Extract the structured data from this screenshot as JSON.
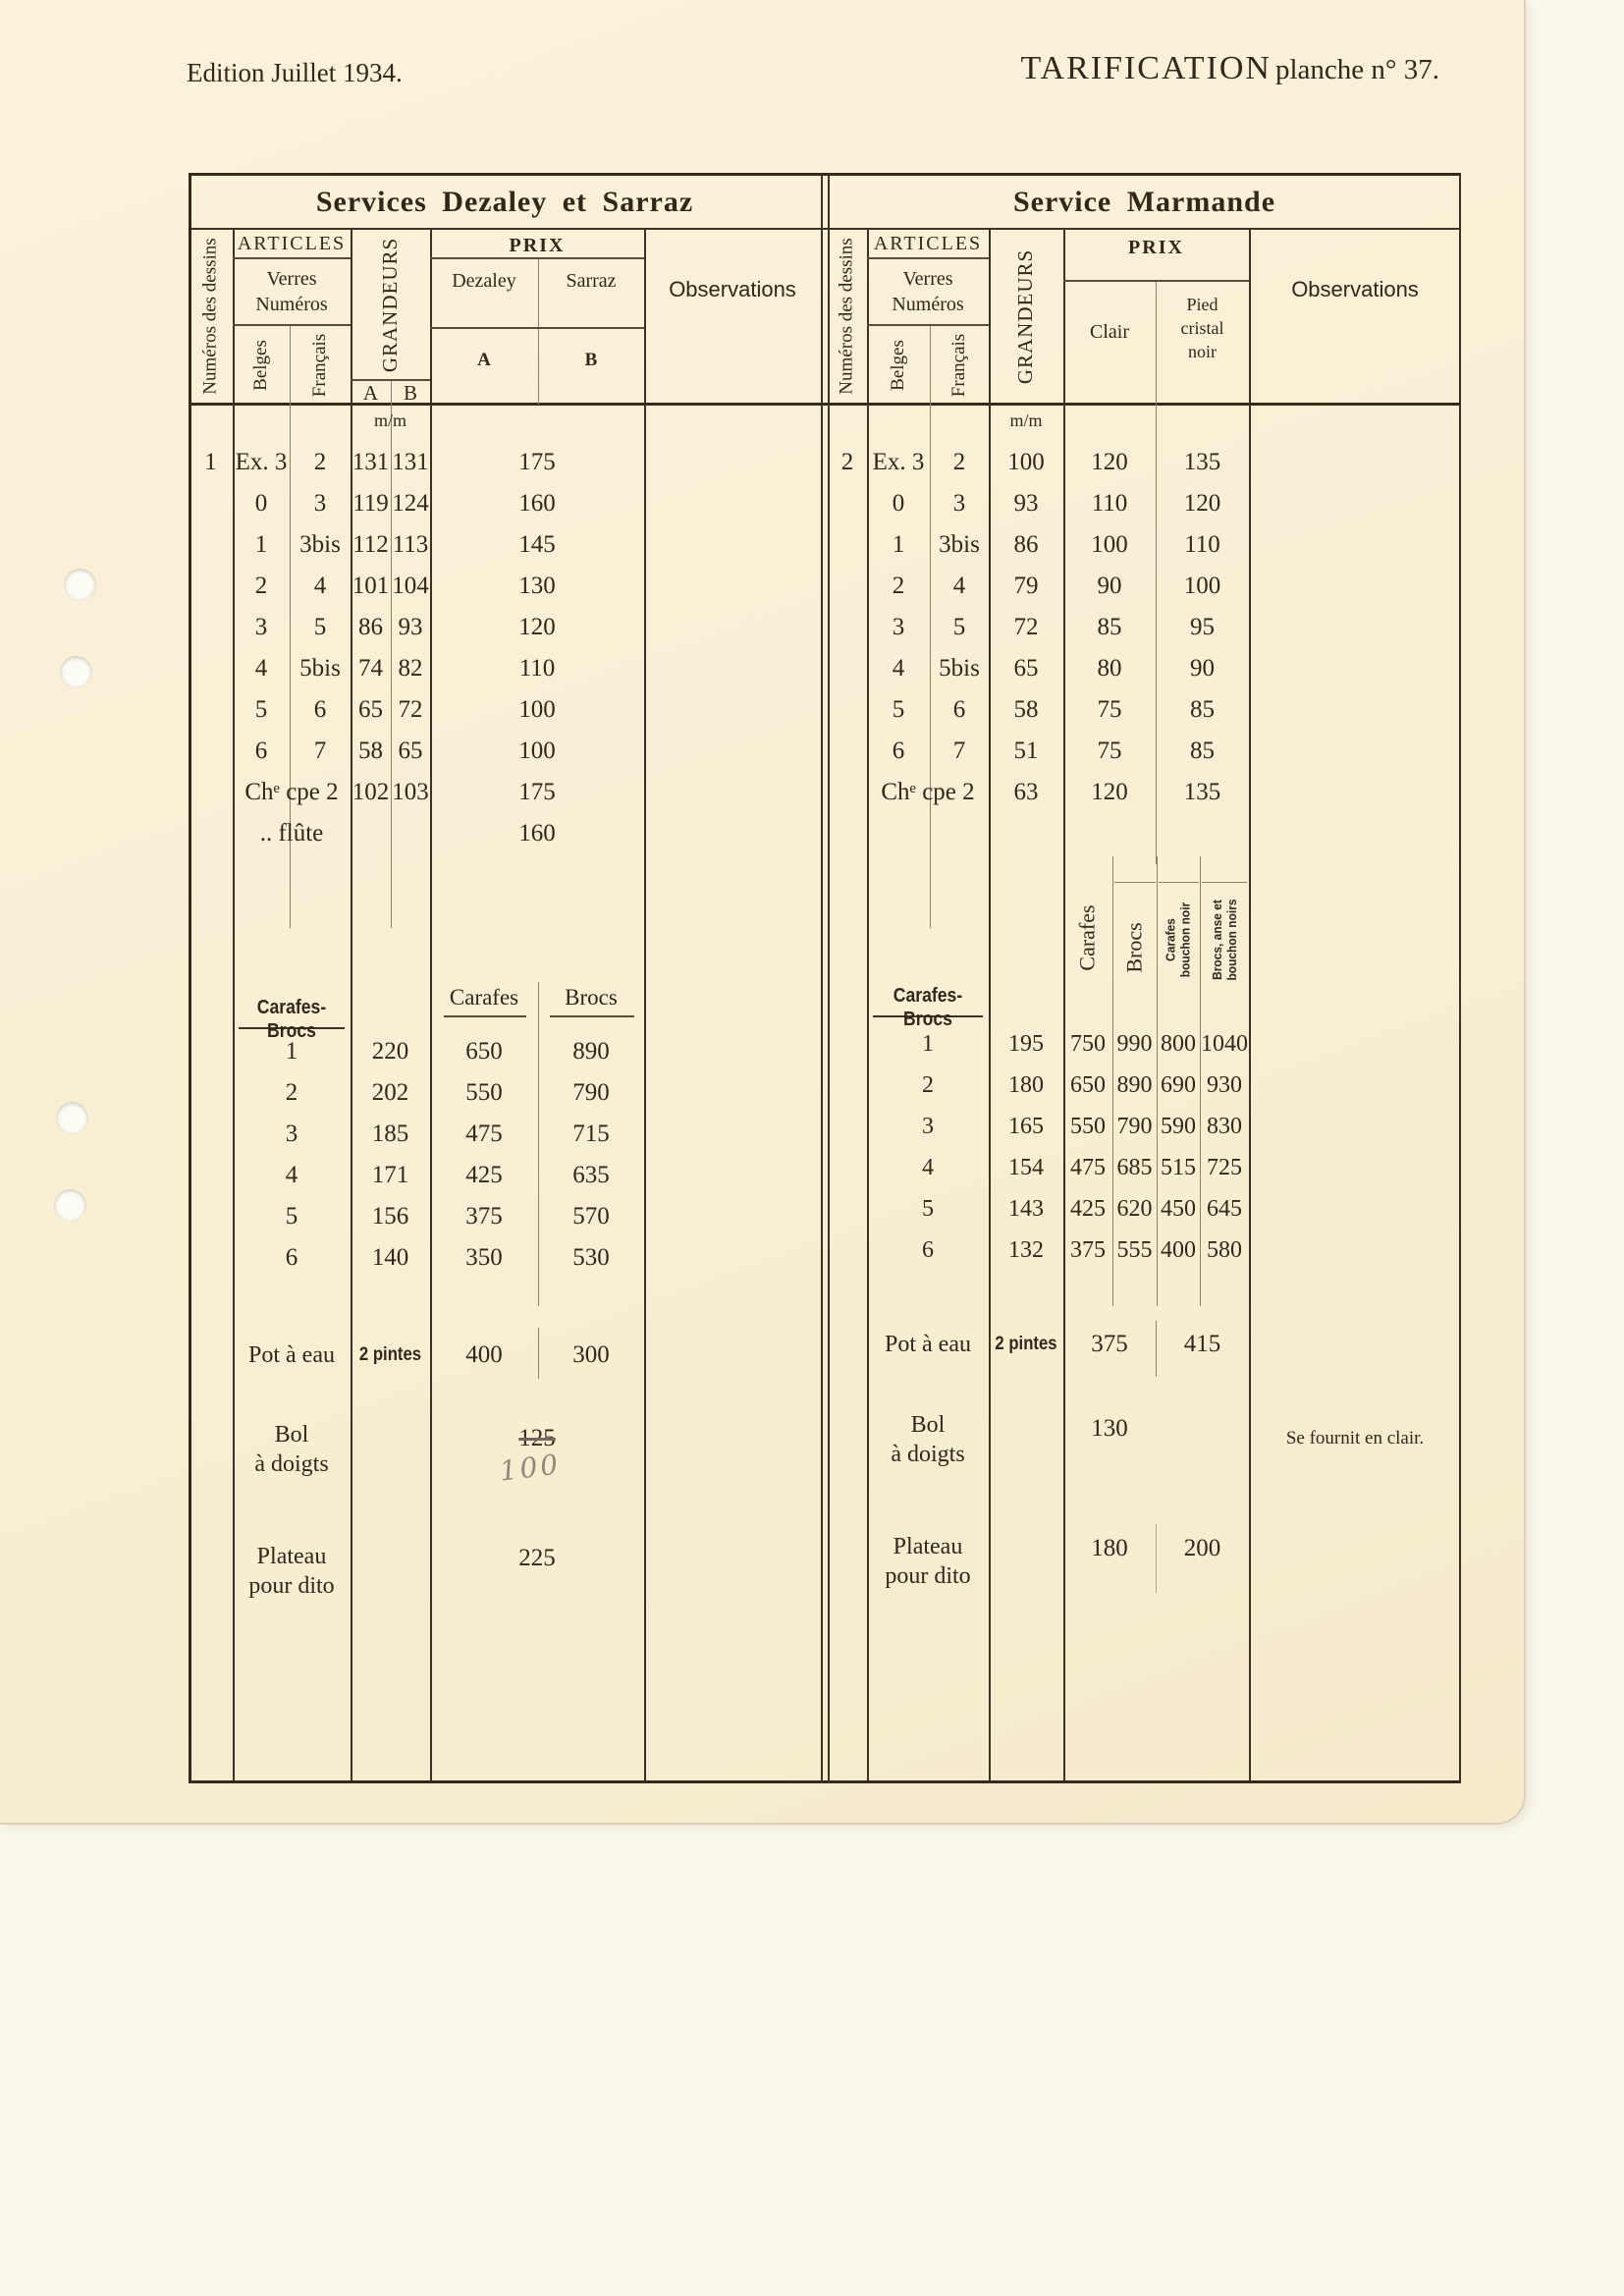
{
  "page": {
    "edition": "Edition Juillet 1934.",
    "title": "TARIFICATION",
    "subtitle": "planche n° 37."
  },
  "left": {
    "title": "Services Dezaley et Sarraz",
    "dessin": "1",
    "h": {
      "dessins": "Numéros des dessins",
      "articles": "ARTICLES",
      "verres": "Verres",
      "numeros": "Numéros",
      "belges": "Belges",
      "francais": "Français",
      "grandeurs": "GRANDEURS",
      "ga": "A",
      "gb": "B",
      "prix": "PRIX",
      "dezaley": "Dezaley",
      "sarraz": "Sarraz",
      "pa": "A",
      "pb": "B",
      "obs": "Observations",
      "mm": "m/m"
    },
    "rows": [
      {
        "b": "Ex. 3",
        "f": "2",
        "ga": "131",
        "gb": "131",
        "p": "175"
      },
      {
        "b": "0",
        "f": "3",
        "ga": "119",
        "gb": "124",
        "p": "160"
      },
      {
        "b": "1",
        "f": "3bis",
        "ga": "112",
        "gb": "113",
        "p": "145"
      },
      {
        "b": "2",
        "f": "4",
        "ga": "101",
        "gb": "104",
        "p": "130"
      },
      {
        "b": "3",
        "f": "5",
        "ga": "86",
        "gb": "93",
        "p": "120"
      },
      {
        "b": "4",
        "f": "5bis",
        "ga": "74",
        "gb": "82",
        "p": "110"
      },
      {
        "b": "5",
        "f": "6",
        "ga": "65",
        "gb": "72",
        "p": "100"
      },
      {
        "b": "6",
        "f": "7",
        "ga": "58",
        "gb": "65",
        "p": "100"
      }
    ],
    "coupe": {
      "label": "Chᵉ cpe 2",
      "ga": "102",
      "gb": "103",
      "p": "175"
    },
    "flute": {
      "label": ".. flûte",
      "p": "160"
    },
    "car": {
      "label": "Carafes-Brocs",
      "carafes": "Carafes",
      "brocs": "Brocs",
      "rows": [
        {
          "n": "1",
          "g": "220",
          "x": "650",
          "y": "890"
        },
        {
          "n": "2",
          "g": "202",
          "x": "550",
          "y": "790"
        },
        {
          "n": "3",
          "g": "185",
          "x": "475",
          "y": "715"
        },
        {
          "n": "4",
          "g": "171",
          "x": "425",
          "y": "635"
        },
        {
          "n": "5",
          "g": "156",
          "x": "375",
          "y": "570"
        },
        {
          "n": "6",
          "g": "140",
          "x": "350",
          "y": "530"
        }
      ]
    },
    "pot": {
      "label": "Pot à eau",
      "size": "2 pintes",
      "a": "400",
      "b": "300"
    },
    "bol": {
      "l1": "Bol",
      "l2": "à doigts",
      "old": "125",
      "hand": "100"
    },
    "plat": {
      "l1": "Plateau",
      "l2": "pour dito",
      "p": "225"
    }
  },
  "right": {
    "title": "Service Marmande",
    "dessin": "2",
    "h": {
      "dessins": "Numéros des dessins",
      "articles": "ARTICLES",
      "verres": "Verres",
      "numeros": "Numéros",
      "belges": "Belges",
      "francais": "Français",
      "grandeurs": "GRANDEURS",
      "prix": "PRIX",
      "clair": "Clair",
      "pied1": "Pied",
      "pied2": "cristal",
      "pied3": "noir",
      "obs": "Observations",
      "mm": "m/m"
    },
    "rows": [
      {
        "b": "Ex. 3",
        "f": "2",
        "g": "100",
        "c": "120",
        "p": "135"
      },
      {
        "b": "0",
        "f": "3",
        "g": "93",
        "c": "110",
        "p": "120"
      },
      {
        "b": "1",
        "f": "3bis",
        "g": "86",
        "c": "100",
        "p": "110"
      },
      {
        "b": "2",
        "f": "4",
        "g": "79",
        "c": "90",
        "p": "100"
      },
      {
        "b": "3",
        "f": "5",
        "g": "72",
        "c": "85",
        "p": "95"
      },
      {
        "b": "4",
        "f": "5bis",
        "g": "65",
        "c": "80",
        "p": "90"
      },
      {
        "b": "5",
        "f": "6",
        "g": "58",
        "c": "75",
        "p": "85"
      },
      {
        "b": "6",
        "f": "7",
        "g": "51",
        "c": "75",
        "p": "85"
      }
    ],
    "coupe": {
      "label": "Chᵉ cpe 2",
      "g": "63",
      "c": "120",
      "p": "135"
    },
    "car": {
      "label": "Carafes-Brocs",
      "v1": "Carafes",
      "v2": "Brocs",
      "v3a": "Carafes",
      "v3b": "bouchon noir",
      "v4a": "Brocs, anse et",
      "v4b": "bouchon noirs",
      "rows": [
        {
          "n": "1",
          "g": "195",
          "a": "750",
          "b": "990",
          "c": "800",
          "d": "1040"
        },
        {
          "n": "2",
          "g": "180",
          "a": "650",
          "b": "890",
          "c": "690",
          "d": "930"
        },
        {
          "n": "3",
          "g": "165",
          "a": "550",
          "b": "790",
          "c": "590",
          "d": "830"
        },
        {
          "n": "4",
          "g": "154",
          "a": "475",
          "b": "685",
          "c": "515",
          "d": "725"
        },
        {
          "n": "5",
          "g": "143",
          "a": "425",
          "b": "620",
          "c": "450",
          "d": "645"
        },
        {
          "n": "6",
          "g": "132",
          "a": "375",
          "b": "555",
          "c": "400",
          "d": "580"
        }
      ]
    },
    "pot": {
      "label": "Pot à eau",
      "size": "2 pintes",
      "c": "375",
      "p": "415"
    },
    "bol": {
      "l1": "Bol",
      "l2": "à doigts",
      "c": "130",
      "obs": "Se fournit en clair."
    },
    "plat": {
      "l1": "Plateau",
      "l2": "pour dito",
      "c": "180",
      "p": "200"
    }
  }
}
